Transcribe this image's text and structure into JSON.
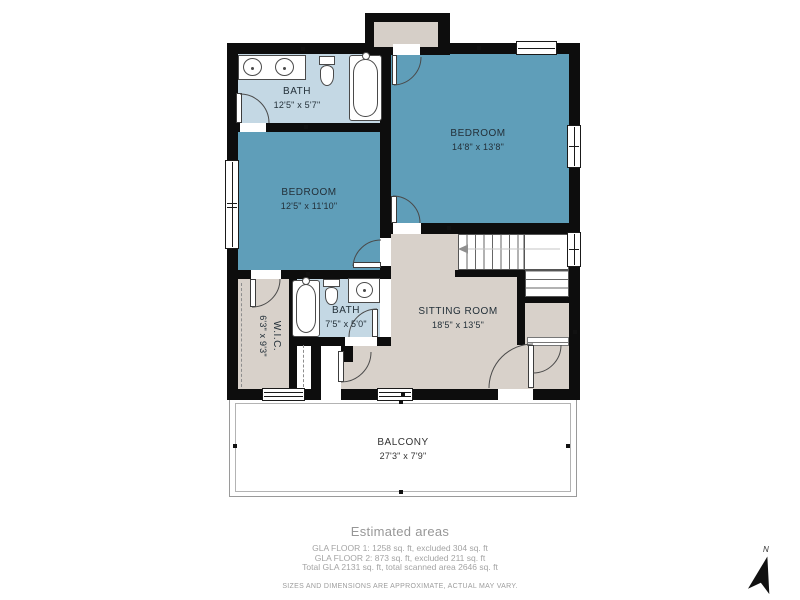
{
  "colors": {
    "wall": "#0d0d0d",
    "bedroom_fill": "#5f9eb9",
    "bath_fill": "#c4d8e4",
    "living_fill": "#d8d1ca",
    "chimney_fill": "#d6cfc8",
    "fixture_stroke": "#4a4a4a",
    "room_text": "#233039",
    "muted_text": "#9e9e9e",
    "balcony_line": "#9a9a9a"
  },
  "rooms": [
    {
      "id": "bath-upper",
      "name": "BATH",
      "dims": "12'5\" x 5'7\""
    },
    {
      "id": "bedroom-right",
      "name": "BEDROOM",
      "dims": "14'8\" x 13'8\""
    },
    {
      "id": "bedroom-left",
      "name": "BEDROOM",
      "dims": "12'5\" x 11'10\""
    },
    {
      "id": "wic",
      "name": "W.I.C.",
      "dims": "6'3\" x 9'3\""
    },
    {
      "id": "bath-lower",
      "name": "BATH",
      "dims": "7'5\" x 5'0\""
    },
    {
      "id": "sitting-room",
      "name": "SITTING ROOM",
      "dims": "18'5\" x 13'5\""
    },
    {
      "id": "balcony",
      "name": "BALCONY",
      "dims": "27'3\" x 7'9\""
    }
  ],
  "fixture_icons": [
    "double-sink",
    "toilet",
    "bathtub",
    "single-sink",
    "stairs",
    "door-swing"
  ],
  "footer": {
    "title": "Estimated areas",
    "line1": "GLA FLOOR 1: 1258 sq. ft, excluded 304 sq. ft",
    "line2": "GLA FLOOR 2: 873 sq. ft, excluded 211 sq. ft",
    "line3": "Total GLA 2131 sq. ft, total scanned area 2646 sq. ft",
    "disclaimer": "SIZES AND DIMENSIONS ARE APPROXIMATE, ACTUAL MAY VARY."
  },
  "compass": {
    "label": "N"
  }
}
